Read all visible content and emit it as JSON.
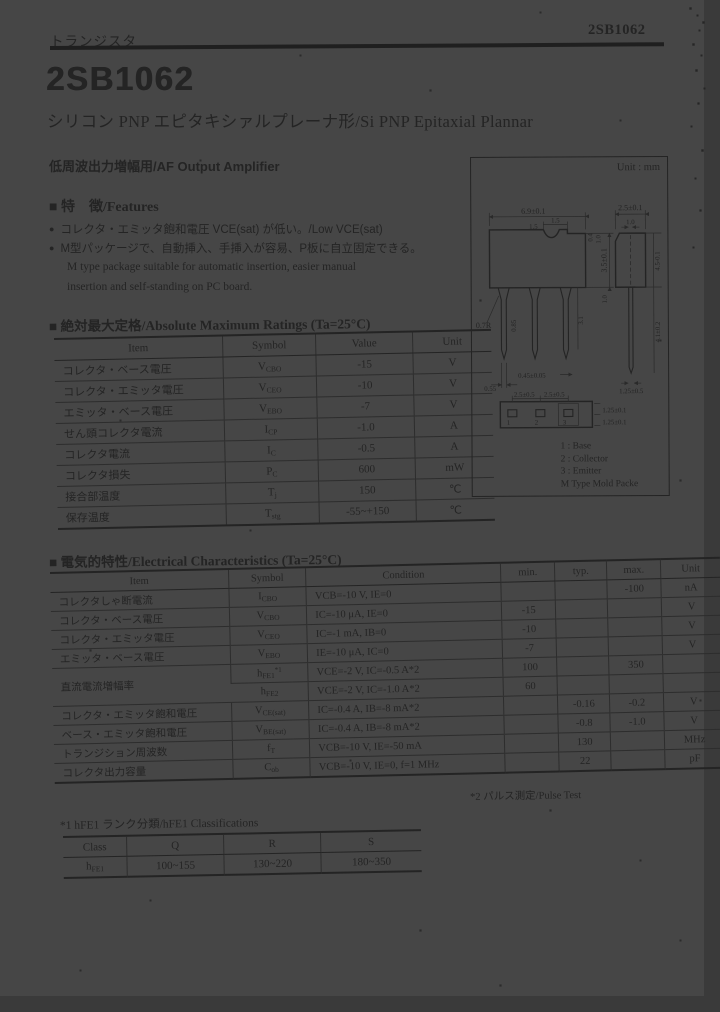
{
  "doc": {
    "header": {
      "category": "トランジスタ",
      "part_number": "2SB1062"
    },
    "title": "2SB1062",
    "subtitle": "シリコン PNP エピタキシァルプレーナ形/Si PNP Epitaxial Plannar",
    "application": "低周波出力増幅用/AF Output Amplifier",
    "features": {
      "heading": "■ 特　徴/Features",
      "bullet_icon": "●",
      "bullet1": "コレクタ・エミッタ飽和電圧 VCE(sat) が低い。/Low VCE(sat)",
      "bullet2": "M型パッケージで、自動挿入、手挿入が容易、P板に自立固定できる。",
      "note_line1": "M type package suitable for automatic insertion, easier manual",
      "note_line2": "insertion and self-standing on PC board."
    }
  },
  "abs_max": {
    "heading": "■ 絶対最大定格/Absolute Maximum Ratings (Ta=25°C)",
    "headers": [
      "Item",
      "Symbol",
      "Value",
      "Unit"
    ],
    "rows": [
      {
        "item": "コレクタ・ベース電圧",
        "sym": "V",
        "sub": "CBO",
        "value": "-15",
        "unit": "V"
      },
      {
        "item": "コレクタ・エミッタ電圧",
        "sym": "V",
        "sub": "CEO",
        "value": "-10",
        "unit": "V"
      },
      {
        "item": "エミッタ・ベース電圧",
        "sym": "V",
        "sub": "EBO",
        "value": "-7",
        "unit": "V"
      },
      {
        "item": "せん頭コレクタ電流",
        "sym": "I",
        "sub": "CP",
        "value": "-1.0",
        "unit": "A"
      },
      {
        "item": "コレクタ電流",
        "sym": "I",
        "sub": "C",
        "value": "-0.5",
        "unit": "A"
      },
      {
        "item": "コレクタ損失",
        "sym": "P",
        "sub": "C",
        "value": "600",
        "unit": "mW"
      },
      {
        "item": "接合部温度",
        "sym": "T",
        "sub": "j",
        "value": "150",
        "unit": "℃"
      },
      {
        "item": "保存温度",
        "sym": "T",
        "sub": "stg",
        "value": "-55~+150",
        "unit": "℃"
      }
    ]
  },
  "elec": {
    "heading": "■ 電気的特性/Electrical Characteristics (Ta=25°C)",
    "headers": [
      "Item",
      "Symbol",
      "Condition",
      "min.",
      "typ.",
      "max.",
      "Unit"
    ],
    "footnote": "*2 パルス測定/Pulse Test",
    "rows": [
      {
        "item": "コレクタしゃ断電流",
        "sym": "I",
        "sub": "CBO",
        "sup": "",
        "cond": "VCB=-10 V, IE=0",
        "min": "",
        "typ": "",
        "max": "-100",
        "unit": "nA"
      },
      {
        "item": "コレクタ・ベース電圧",
        "sym": "V",
        "sub": "CBO",
        "sup": "",
        "cond": "IC=-10 μA, IE=0",
        "min": "-15",
        "typ": "",
        "max": "",
        "unit": "V"
      },
      {
        "item": "コレクタ・エミッタ電圧",
        "sym": "V",
        "sub": "CEO",
        "sup": "",
        "cond": "IC=-1 mA, IB=0",
        "min": "-10",
        "typ": "",
        "max": "",
        "unit": "V"
      },
      {
        "item": "エミッタ・ベース電圧",
        "sym": "V",
        "sub": "EBO",
        "sup": "",
        "cond": "IE=-10 μA, IC=0",
        "min": "-7",
        "typ": "",
        "max": "",
        "unit": "V"
      },
      {
        "item": "直流電流増幅率",
        "sym": "h",
        "sub": "FE1",
        "sup": "*1",
        "cond": "VCE=-2 V, IC=-0.5 A*2",
        "min": "100",
        "typ": "",
        "max": "350",
        "unit": ""
      },
      {
        "item": "",
        "sym": "h",
        "sub": "FE2",
        "sup": "",
        "cond": "VCE=-2 V, IC=-1.0 A*2",
        "min": "60",
        "typ": "",
        "max": "",
        "unit": ""
      },
      {
        "item": "コレクタ・エミッタ飽和電圧",
        "sym": "V",
        "sub": "CE(sat)",
        "sup": "",
        "cond": "IC=-0.4 A, IB=-8 mA*2",
        "min": "",
        "typ": "-0.16",
        "max": "-0.2",
        "unit": "V"
      },
      {
        "item": "ベース・エミッタ飽和電圧",
        "sym": "V",
        "sub": "BE(sat)",
        "sup": "",
        "cond": "IC=-0.4 A, IB=-8 mA*2",
        "min": "",
        "typ": "-0.8",
        "max": "-1.0",
        "unit": "V"
      },
      {
        "item": "トランジション周波数",
        "sym": "f",
        "sub": "T",
        "sup": "",
        "cond": "VCB=-10 V, IE=-50 mA",
        "min": "",
        "typ": "130",
        "max": "",
        "unit": "MHz"
      },
      {
        "item": "コレクタ出力容量",
        "sym": "C",
        "sub": "ob",
        "sup": "",
        "cond": "VCB=-10 V, IE=0, f=1 MHz",
        "min": "",
        "typ": "22",
        "max": "",
        "unit": "pF"
      }
    ]
  },
  "classification": {
    "heading": "*1 hFE1 ランク分類/hFE1 Classifications",
    "headers": [
      "Class",
      "Q",
      "R",
      "S"
    ],
    "row_label": {
      "sym": "h",
      "sub": "FE1"
    },
    "values": [
      "100~155",
      "130~220",
      "180~350"
    ]
  },
  "pkg": {
    "unit": "Unit : mm",
    "pins": [
      "1",
      "2",
      "3"
    ],
    "legend": [
      "1 : Base",
      "2 : Collector",
      "3 : Emitter",
      "M Type Mold Packe"
    ],
    "dims": {
      "body_w": "6.9±0.1",
      "notch_a": "1.5",
      "notch_b": "1.5",
      "step_a": "0.4",
      "step_b": "1.0",
      "body_h": "3.5±0.1",
      "shoulder_h": "1.0",
      "flare": "0.7R",
      "lead_w": "0.85",
      "lead_len": "3.1",
      "tip": "0.45±0.05",
      "lead_w2": "0.55",
      "side_w": "2.5±0.1",
      "side_lead_w": "1.0",
      "side_h": "4.5-0.1",
      "side_lead_len": "4.1±0.2",
      "side_tip_pitch": "1.25±0.5",
      "pitch_a": "2.5±0.5",
      "pitch_b": "2.5±0.5",
      "off_a": "1.25±0.1",
      "off_b": "1.25±0.1"
    }
  }
}
